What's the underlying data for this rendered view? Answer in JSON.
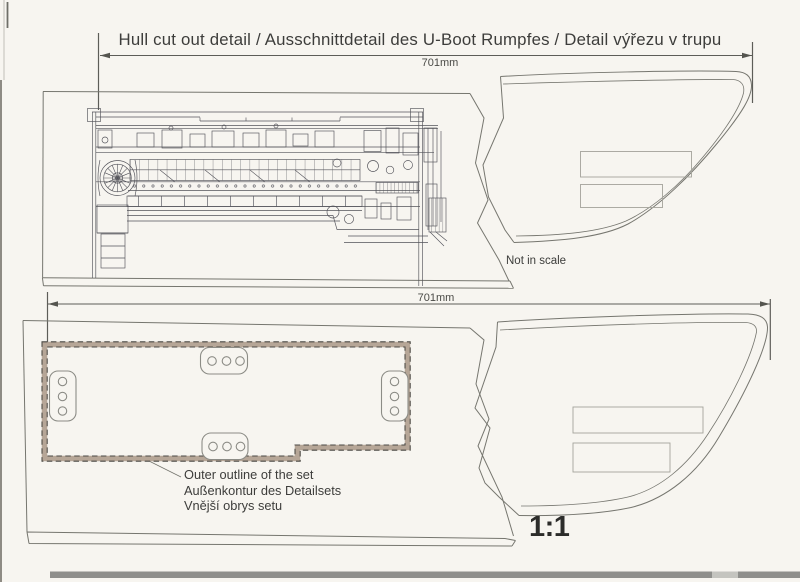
{
  "colors": {
    "paper": "#f7f5f0",
    "outline": "#76766f",
    "machine": "#53535a",
    "ink": "#3d3d3b",
    "dim": "#5d5d58",
    "band": "#b6a697",
    "dash": "#4a4843",
    "faint": "#a3a39b",
    "scan": "#8f8f8c"
  },
  "header": {
    "title": "Hull cut out detail / Ausschnittdetail des U-Boot Rumpfes / Detail výřezu v trupu"
  },
  "upper_view": {
    "dimension_label": "701mm",
    "note": "Not in scale"
  },
  "lower_view": {
    "dimension_label": "701mm",
    "scale_label": "1:1",
    "outline_labels": [
      "Outer outline of the set",
      "Außenkontur des Detailsets",
      "Vnější obrys setu"
    ]
  }
}
